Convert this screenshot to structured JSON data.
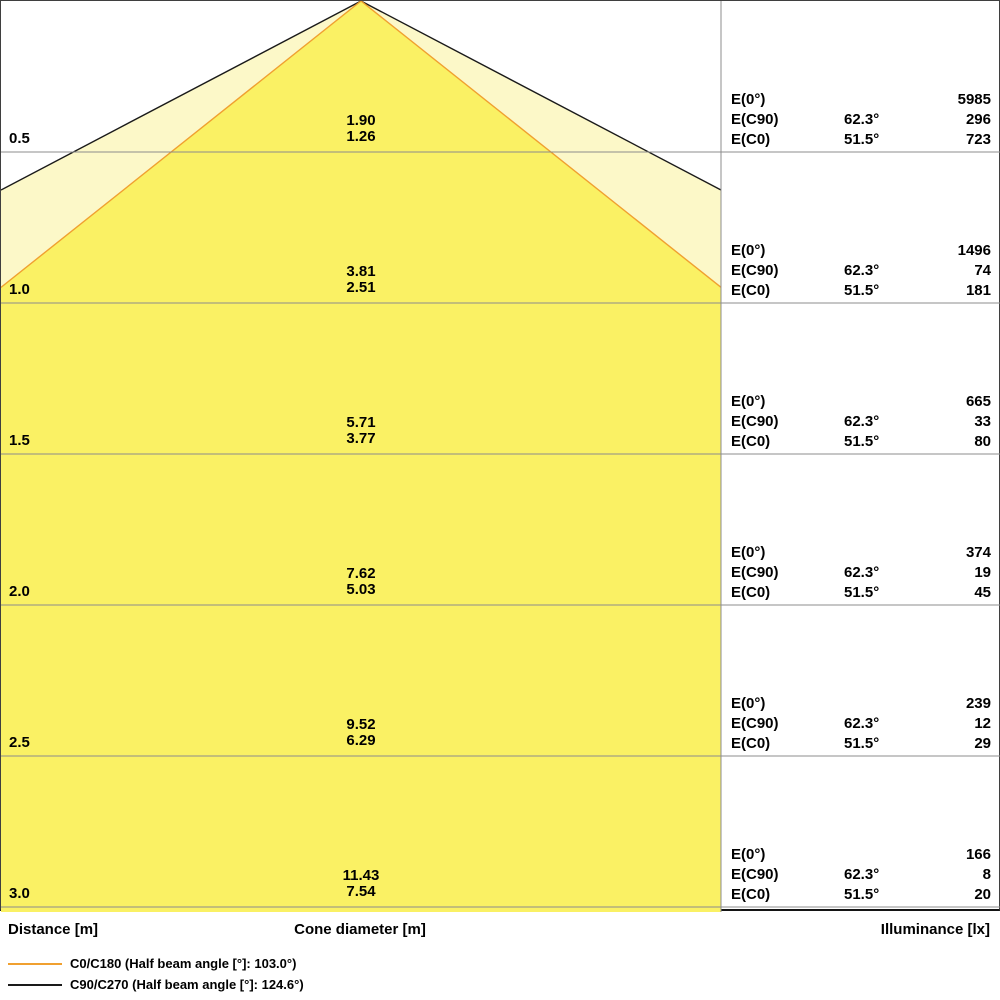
{
  "footer": {
    "distance_label": "Distance [m]",
    "cone_diameter_label": "Cone diameter [m]",
    "illuminance_label": "Illuminance [lx]"
  },
  "legend": {
    "items": [
      {
        "name": "C0/C180",
        "label": "C0/C180 (Half beam angle [°]: 103.0°)",
        "color": "#F0A030"
      },
      {
        "name": "C90/C270",
        "label": "C90/C270 (Half beam angle [°]: 124.6°)",
        "color": "#1A1A1A"
      }
    ]
  },
  "colors": {
    "cone_inner_fill": "#FAF164",
    "cone_outer_fill": "#FCF8C8",
    "c0_line": "#F0A030",
    "c90_line": "#1A1A1A",
    "grid_line": "#8C8C8C",
    "divider_line": "#8C8C8C",
    "border": "#3F3F3F",
    "text": "#000000",
    "background": "#FFFFFF"
  },
  "chart_data": {
    "type": "area",
    "title": "Light cone diagram",
    "ylabel": "Distance [m]",
    "xlabel": "Cone diameter [m]",
    "value_label": "Illuminance [lx]",
    "half_beam_angles_deg": {
      "C0_C180": 103.0,
      "C90_C270": 124.6
    },
    "half_angles_deg": {
      "C90": 62.3,
      "C0": 51.5
    },
    "row_labels": {
      "e0": "E(0°)",
      "ec90": "E(C90)",
      "ec0": "E(C0)"
    },
    "angle_labels": {
      "ec90": "62.3°",
      "ec0": "51.5°"
    },
    "distances_m": [
      0.5,
      1.0,
      1.5,
      2.0,
      2.5,
      3.0
    ],
    "rows": [
      {
        "distance": "0.5",
        "cone_diameter_c90": "1.90",
        "cone_diameter_c0": "1.26",
        "illuminance_e0": "5985",
        "illuminance_ec90": "296",
        "illuminance_ec0": "723"
      },
      {
        "distance": "1.0",
        "cone_diameter_c90": "3.81",
        "cone_diameter_c0": "2.51",
        "illuminance_e0": "1496",
        "illuminance_ec90": "74",
        "illuminance_ec0": "181"
      },
      {
        "distance": "1.5",
        "cone_diameter_c90": "5.71",
        "cone_diameter_c0": "3.77",
        "illuminance_e0": "665",
        "illuminance_ec90": "33",
        "illuminance_ec0": "80"
      },
      {
        "distance": "2.0",
        "cone_diameter_c90": "7.62",
        "cone_diameter_c0": "5.03",
        "illuminance_e0": "374",
        "illuminance_ec90": "19",
        "illuminance_ec0": "45"
      },
      {
        "distance": "2.5",
        "cone_diameter_c90": "9.52",
        "cone_diameter_c0": "6.29",
        "illuminance_e0": "239",
        "illuminance_ec90": "12",
        "illuminance_ec0": "29"
      },
      {
        "distance": "3.0",
        "cone_diameter_c90": "11.43",
        "cone_diameter_c0": "7.54",
        "illuminance_e0": "166",
        "illuminance_ec90": "8",
        "illuminance_ec0": "20"
      }
    ]
  }
}
